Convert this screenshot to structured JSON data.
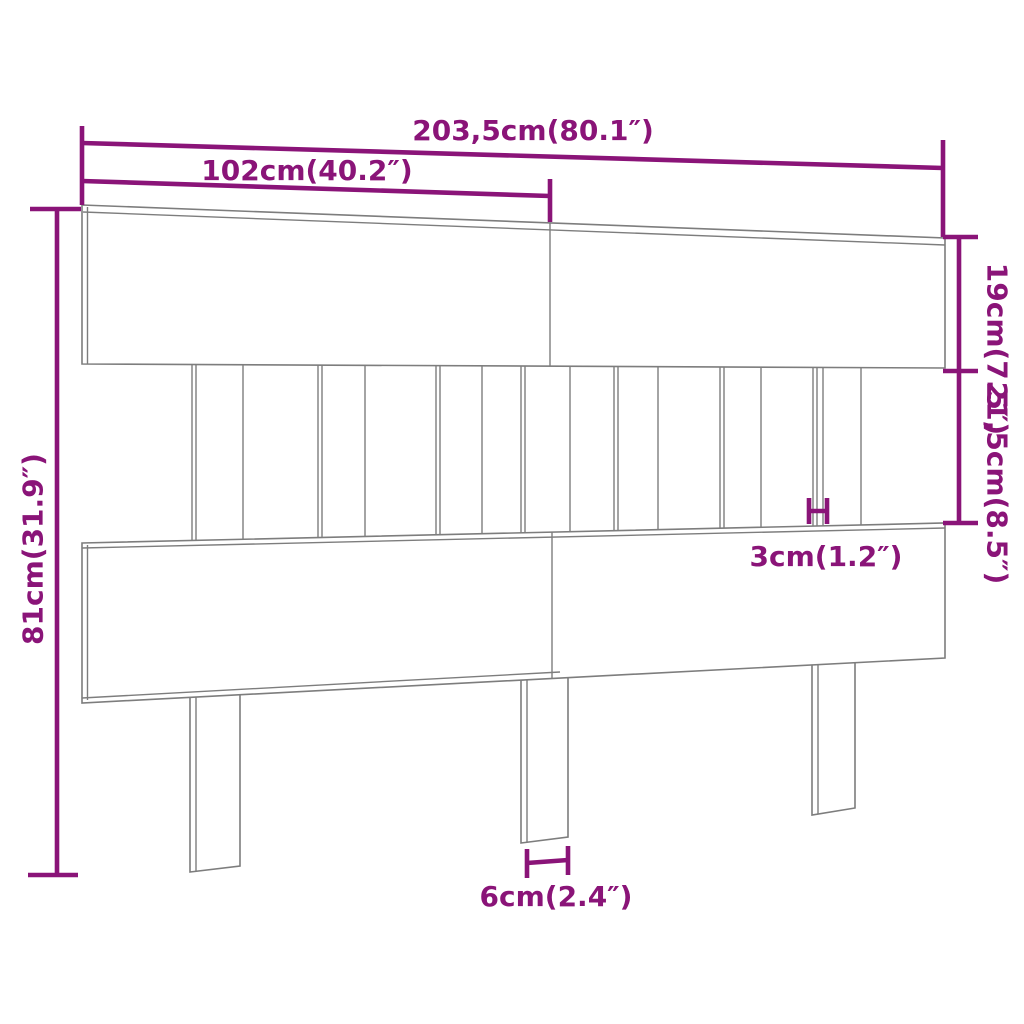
{
  "diagram": {
    "kind": "headboard-dimension-diagram",
    "accent_color": "#8a1478",
    "line_color": "#7d7d7d",
    "background_color": "#ffffff",
    "labels": {
      "total_width": "203,5cm(80.1″)",
      "half_width": "102cm(40.2″)",
      "top_board_height": "19cm(7.5″)",
      "middle_section_height": "21,5cm(8.5″)",
      "total_height": "81cm(31.9″)",
      "slat_width": "3cm(1.2″)",
      "leg_width": "6cm(2.4″)"
    }
  }
}
